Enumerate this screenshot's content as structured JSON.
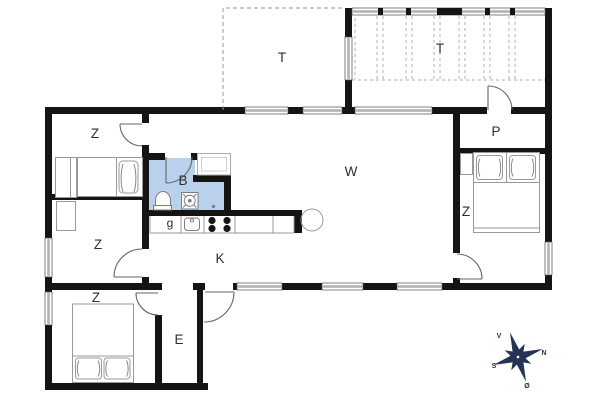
{
  "title": "summer-house-floor-plan",
  "colors": {
    "wall": "#141414",
    "window": "#b4b4b4",
    "bath": "#b9d1ec",
    "compass": "#253354"
  },
  "rooms": [
    {
      "id": "terrace-open",
      "label": "T"
    },
    {
      "id": "terrace-covered",
      "label": "T"
    },
    {
      "id": "bedroom-nw",
      "label": "Z"
    },
    {
      "id": "bedroom-w",
      "label": "Z"
    },
    {
      "id": "bedroom-sw",
      "label": "Z"
    },
    {
      "id": "bedroom-e",
      "label": "Z"
    },
    {
      "id": "room-p",
      "label": "P"
    },
    {
      "id": "living-room",
      "label": "W"
    },
    {
      "id": "bathroom",
      "label": "B"
    },
    {
      "id": "closet-g",
      "label": "g"
    },
    {
      "id": "kitchen",
      "label": "K"
    },
    {
      "id": "entry",
      "label": "E"
    }
  ],
  "compass": {
    "up_label": "V",
    "right_label": "N",
    "left_label": "S",
    "down_label": "Ø"
  },
  "icons": {
    "toilet": "toilet-symbol",
    "shower": "shower-basin-symbol",
    "sink": "kitchen-sink-symbol",
    "stove": "stove-4-burner-symbol",
    "table": "round-table-symbol",
    "compass": "compass-rose"
  }
}
